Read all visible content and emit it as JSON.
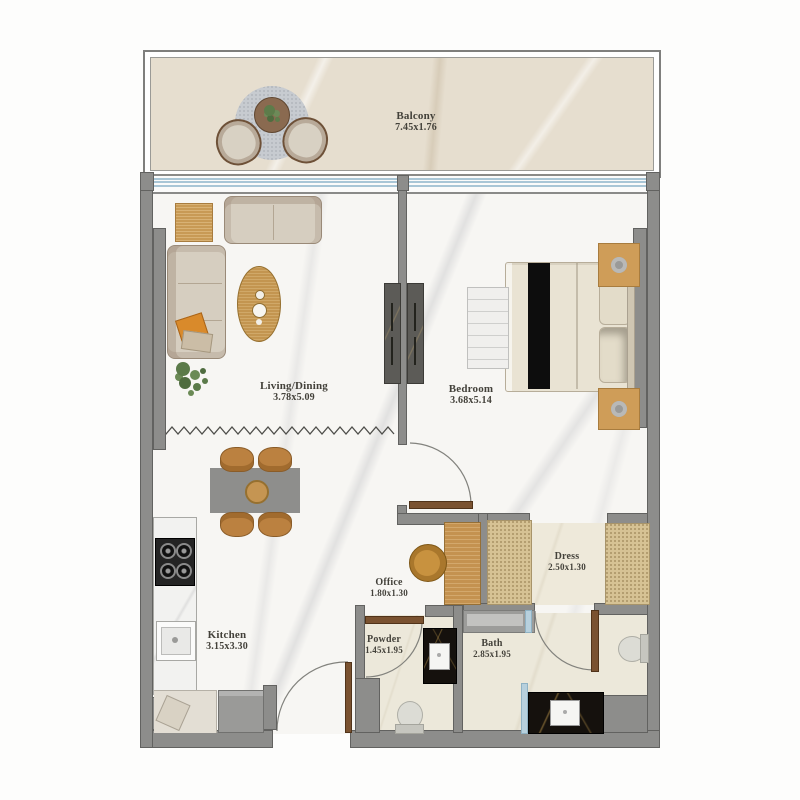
{
  "plan": {
    "rooms": [
      {
        "id": "balcony",
        "name": "Balcony",
        "dims": "7.45x1.76"
      },
      {
        "id": "living-dining",
        "name": "Living/Dining",
        "dims": "3.78x5.09"
      },
      {
        "id": "bedroom",
        "name": "Bedroom",
        "dims": "3.68x5.14"
      },
      {
        "id": "kitchen",
        "name": "Kitchen",
        "dims": "3.15x3.30"
      },
      {
        "id": "office",
        "name": "Office",
        "dims": "1.80x1.30"
      },
      {
        "id": "dress",
        "name": "Dress",
        "dims": "2.50x1.30"
      },
      {
        "id": "powder",
        "name": "Powder",
        "dims": "1.45x1.95"
      },
      {
        "id": "bath",
        "name": "Bath",
        "dims": "2.85x1.95"
      }
    ],
    "colors": {
      "wall": "#8d8d8b",
      "wood_accent": "#c49250",
      "glass": "#b7d0dd",
      "marble_floor": "#f7f6f3",
      "balcony_floor": "#e6decf",
      "tile_floor": "#ece8da",
      "counter_black": "#15110d",
      "label_text": "#43413a"
    }
  }
}
